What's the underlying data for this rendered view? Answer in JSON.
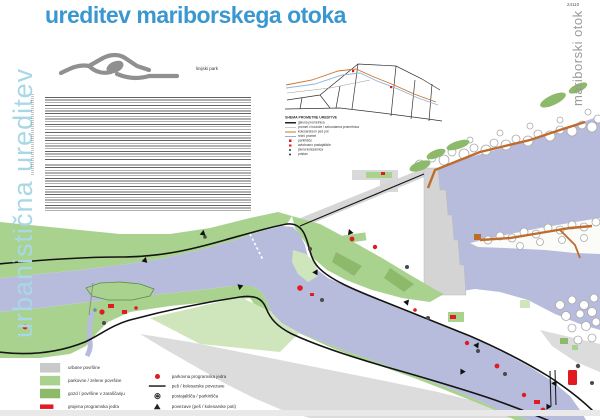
{
  "page": {
    "sheet_number": "24110",
    "title": "ureditev mariborskega otoka",
    "left_vertical_title": "urbanistična ureditev",
    "right_vertical_title": "mariborski otok",
    "logo_label": "linijski park"
  },
  "colors": {
    "title_blue": "#3a97cf",
    "pale_blue": "#a8d8e6",
    "river": "#b7bcdc",
    "green_light": "#a9d28f",
    "green_dark": "#8cba6a",
    "green_pale": "#cfe6bd",
    "urban_gray": "#dcdcdc",
    "red": "#e01b22",
    "orange_path": "#bd6c2e",
    "path_black": "#141414"
  },
  "traffic_scheme": {
    "title": "SHEMA PROMETNE UREDITVE",
    "items": [
      {
        "icon": "s-line-black",
        "label": "glavna prometnica"
      },
      {
        "icon": "s-line-gray",
        "label": "promet v bodoče / sekundarna prometnica"
      },
      {
        "icon": "s-line-orange",
        "label": "kolesarska in peš pot"
      },
      {
        "icon": "s-line-blue",
        "label": "rečni promet"
      },
      {
        "icon": "s-square-red",
        "label": "parkirišče"
      },
      {
        "icon": "s-square-red-sm",
        "label": "avtobusno postajališče"
      },
      {
        "icon": "s-dot-dark",
        "label": "javna kolesarnica"
      },
      {
        "icon": "s-dot-dark",
        "label": "pristan"
      }
    ]
  },
  "map_legend": {
    "left": [
      {
        "icon": "swatch-gray",
        "label": "urbane površine"
      },
      {
        "icon": "swatch-green-light",
        "label": "parkovne / zelene površine"
      },
      {
        "icon": "swatch-green-dark",
        "label": "gozd / površine v zaraščanju"
      },
      {
        "icon": "swatch-red",
        "label": "grajena programska jedra"
      }
    ],
    "right": [
      {
        "icon": "dot-red",
        "label": "parkovna programska jedra"
      },
      {
        "icon": "line-dark",
        "label": "peš / kolesarske povezave"
      },
      {
        "icon": "ring-dot",
        "label": "postajališča / parkirišča"
      },
      {
        "icon": "triangle-dark",
        "label": "povezave (peš / kolesarske poti)"
      }
    ]
  }
}
